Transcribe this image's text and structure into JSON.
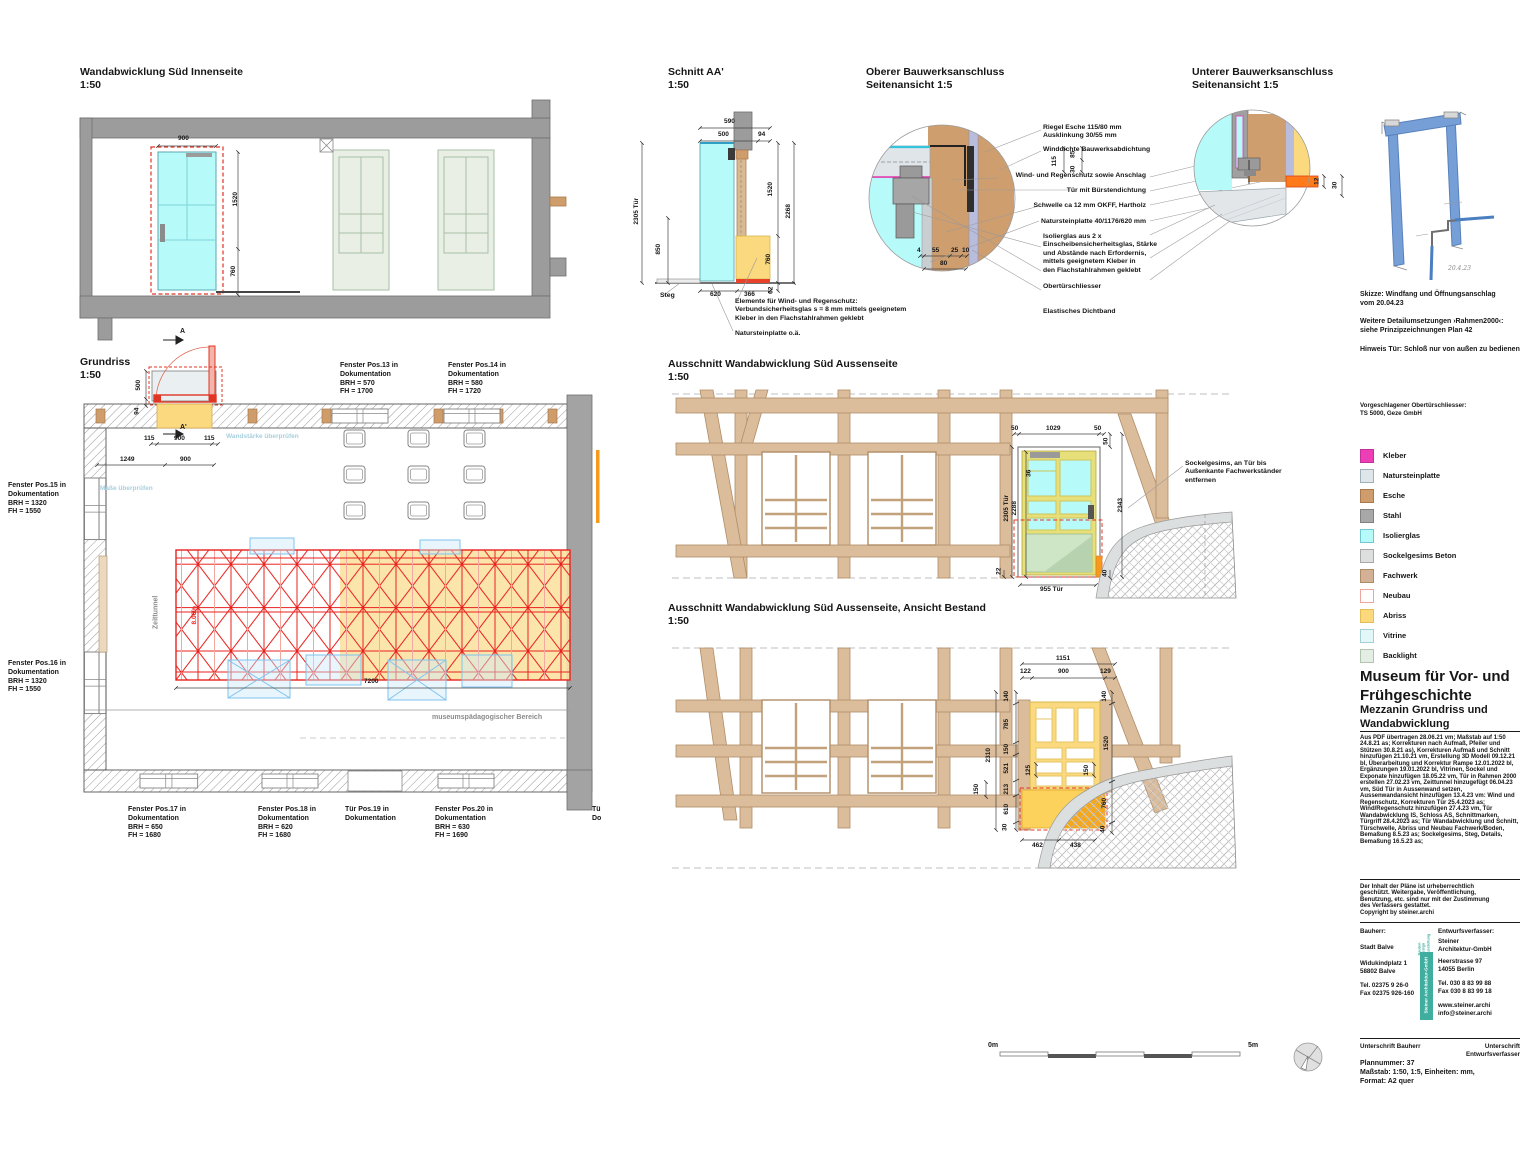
{
  "titles": {
    "innenseite": "Wandabwicklung Süd Innenseite\n1:50",
    "grundriss": "Grundriss\n1:50",
    "schnitt": "Schnitt AA'\n1:50",
    "oberer": "Oberer Bauwerksanschluss\nSeitenansicht 1:5",
    "unterer": "Unterer Bauwerksanschluss\nSeitenansicht 1:5",
    "aussen1": "Ausschnitt Wandabwicklung Süd Aussenseite\n1:50",
    "aussen2": "Ausschnitt Wandabwicklung Süd Aussenseite, Ansicht Bestand\n1:50"
  },
  "pos_labels": {
    "pos13": "Fenster Pos.13 in\nDokumentation\nBRH = 570\nFH = 1700",
    "pos14": "Fenster Pos.14 in\nDokumentation\nBRH = 580\nFH = 1720",
    "pos15": "Fenster Pos.15 in\nDokumentation\nBRH = 1320\nFH = 1550",
    "pos16": "Fenster Pos.16 in\nDokumentation\nBRH = 1320\nFH = 1550",
    "pos17": "Fenster Pos.17 in\nDokumentation\nBRH = 650\nFH = 1680",
    "pos18": "Fenster Pos.18 in\nDokumentation\nBRH = 620\nFH = 1680",
    "pos19": "Tür Pos.19 in\nDokumentation",
    "pos20": "Fenster Pos.20 in\nDokumentation\nBRH = 630\nFH = 1690",
    "pos21_clipped": "Tü\nDo"
  },
  "plan_notes": {
    "wandstaerke": "Wandstärke überprüfen",
    "masse": "Maße überprüfen",
    "museum": "museumspädagogischer Bereich",
    "zeittunnel": "Zeittunnel",
    "slope": "8.06%"
  },
  "section_marks": {
    "top": "A",
    "bottom": "A'"
  },
  "schnitt_labels": {
    "steg": "Steg",
    "elemente": "Elemente für Wind- und Regenschutz:\nVerbundsicherheitsglas s = 8 mm mittels geeignetem\nKleber in den Flachstahlrahmen geklebt",
    "naturstein": "Natursteinplatte o.ä."
  },
  "detail_callouts": [
    "Riegel Esche 115/80 mm\nAusklinkung 30/55 mm",
    "Winddichte Bauwerksabdichtung",
    "Wind- und Regenschutz sowie Anschlag",
    "Tür mit Bürstendichtung",
    "Schwelle ca 12 mm OKFF, Hartholz",
    "Natursteinplatte 40/1176/620 mm",
    "Isolierglas aus 2 x\nEinscheibensicherheitsglas, Stärke\nund Abstände nach Erfordernis,\nmittels geeignetem Kleber in\nden Flachstahlrahmen geklebt",
    "Obertürschliesser",
    "Elastisches Dichtband"
  ],
  "sockelgesims_note": "Sockelgesims, an Tür bis\nAußenkante Fachwerkständer\nentfernen",
  "sketch_notes": {
    "skizze": "Skizze: Windfang und Öffnungsanschlag\nvom 20.04.23",
    "weitere": "Weitere Detailumsetzungen ›Rahmen2000‹:\nsiehe Prinzipzeichnungen Plan 42",
    "hinweis": "Hinweis Tür: Schloß nur von außen zu bedienen",
    "handwriting": "20.4.23"
  },
  "closer_note": "Vorgeschlagener Obertürschliesser:\nTS 5000, Geze GmbH",
  "legend": {
    "items": [
      {
        "label": "Kleber",
        "color": "#ee3eb5",
        "border": "#c2309a"
      },
      {
        "label": "Natursteinplatte",
        "color": "#dee6ea",
        "border": "#9fb0b8"
      },
      {
        "label": "Esche",
        "color": "#cf9c6b",
        "border": "#a87a4e"
      },
      {
        "label": "Stahl",
        "color": "#a8a8a8",
        "border": "#808080"
      },
      {
        "label": "Isolierglas",
        "color": "#b6fafa",
        "border": "#6fc8cf"
      },
      {
        "label": "Sockelgesims Beton",
        "color": "#dddfdf",
        "border": "#a8a8a8"
      },
      {
        "label": "Fachwerk",
        "color": "#d4b194",
        "border": "#ab8a68"
      },
      {
        "label": "Neubau",
        "color": "#ffffff",
        "border": "#f0a49b"
      },
      {
        "label": "Abriss",
        "color": "#fcd97d",
        "border": "#e3bd55"
      },
      {
        "label": "Vitrine",
        "color": "#e2f8f8",
        "border": "#a5cfd4"
      },
      {
        "label": "Backlight",
        "color": "#e4ede3",
        "border": "#b2c4b0"
      }
    ]
  },
  "titleblock": {
    "title": "Museum für Vor- und\nFrühgeschichte",
    "subtitle": "Mezzanin Grundriss und\nWandabwicklung",
    "revisions": "Aus PDF übertragen 28.06.21 vm; Maßstab auf 1:50 24.8.21 as; Korrekturen nach Aufmaß, Pfeiler und Stützen 30.8.21 as), Korrekturen Aufmaß und Schnitt hinzufügen 21.10.21 vm, Erstellung 3D Modell 09.12.21 bl, Überarbeitung und Korrektur Rampe 12.01.2022 bl, Ergänzungen 19.01.2022 bl, Vitrinen, Sockel und Exponate hinzufügen 18.05.22 vm, Tür in Rahmen 2000 erstellen 27.02.23 vm, Zeittunnel hinzugefügt 06.04.23 vm, Süd Tür in Aussenwand setzen, Aussenwandansicht hinzufügen 13.4.23 vm: Wind und Regenschutz, Korrekturen Tür 25.4.2023 as; Wind/Regenschutz hinzufügen 27.4.23 vm, Tür Wandabwicklung IS, Schloss AS, Schnittmarken, Türgriff 28.4.2023 as; Tür Wandabwicklung und Schnitt, Türschwelle, Abriss und Neubau Fachwerk/Boden, Bemaßung 8.5.23 as; Sockelgesims, Steg, Details, Bemaßung 16.5.23 as;",
    "copyright": "Der Inhalt der Pläne ist urheberrechtlich\ngeschützt. Weitergabe,  Veröffentlichung,\nBenutzung, etc. sind nur mit der Zustimmung\ndes Verfassers gestattet.\nCopyright by steiner.archi"
  },
  "contacts": {
    "bauherr": {
      "label": "Bauherr:",
      "name": "Stadt Balve",
      "address": "Widukindplatz 1\n58802 Balve",
      "phone": "Tel. 02375 9 26-0\nFax 02375 926-160"
    },
    "entwurf": {
      "label": "Entwurfsverfasser:",
      "name": "Steiner\nArchitektur-GmbH",
      "address": "Heerstrasse 97\n14055 Berlin",
      "phone": "Tel. 030 8 83 99 88\nFax 030 8 83 99 18",
      "web": "www.steiner.archi\ninfo@steiner.archi"
    },
    "badge": {
      "tagline": "Bauten\nDesign\nAusstellung",
      "name": "Steiner Architektur-GmbH",
      "teal": "#3fae9f"
    },
    "signatures": {
      "left": "Unterschrift Bauherr",
      "right": "Unterschrift Entwurfsverfasser"
    },
    "plan_info": "Plannummer: 37\nMaßstab: 1:50, 1:5, Einheiten: mm,\nFormat: A2 quer"
  },
  "scalebar": {
    "start": "0m",
    "end": "5m"
  },
  "dims": {
    "innen": [
      "900",
      "1520",
      "760"
    ],
    "plan": [
      "500",
      "94",
      "115",
      "900",
      "115",
      "1249",
      "900",
      "7200"
    ],
    "schnitt": [
      "590",
      "500",
      "94",
      "2305 Tür",
      "850",
      "1520",
      "2268",
      "760",
      "62",
      "620",
      "366"
    ],
    "oberer": [
      "115",
      "85",
      "30",
      "4",
      "55",
      "25",
      "10",
      "80"
    ],
    "unterer": [
      "12",
      "30"
    ],
    "a1": [
      "50",
      "1029",
      "50",
      "50",
      "36",
      "2305 Tür",
      "2288",
      "2343",
      "22",
      "40",
      "955 Tür"
    ],
    "a2": [
      "1151",
      "122",
      "900",
      "129",
      "140",
      "785",
      "150",
      "521",
      "213",
      "610",
      "30",
      "2310",
      "150",
      "125",
      "150",
      "140",
      "1520",
      "760",
      "40",
      "462",
      "438"
    ]
  },
  "colors": {
    "wall_gray": "#9c9c9c",
    "glass_cyan": "#b6fafa",
    "abriss_yellow": "#fbd97e",
    "esche_tan": "#cf9c6b",
    "truss_red": "#e8231f",
    "neubau_red": "#e03424",
    "fachwerk_tan": "#dbbc9b",
    "sketch_blue": "#4a7fc1",
    "teal": "#3fae9f"
  }
}
